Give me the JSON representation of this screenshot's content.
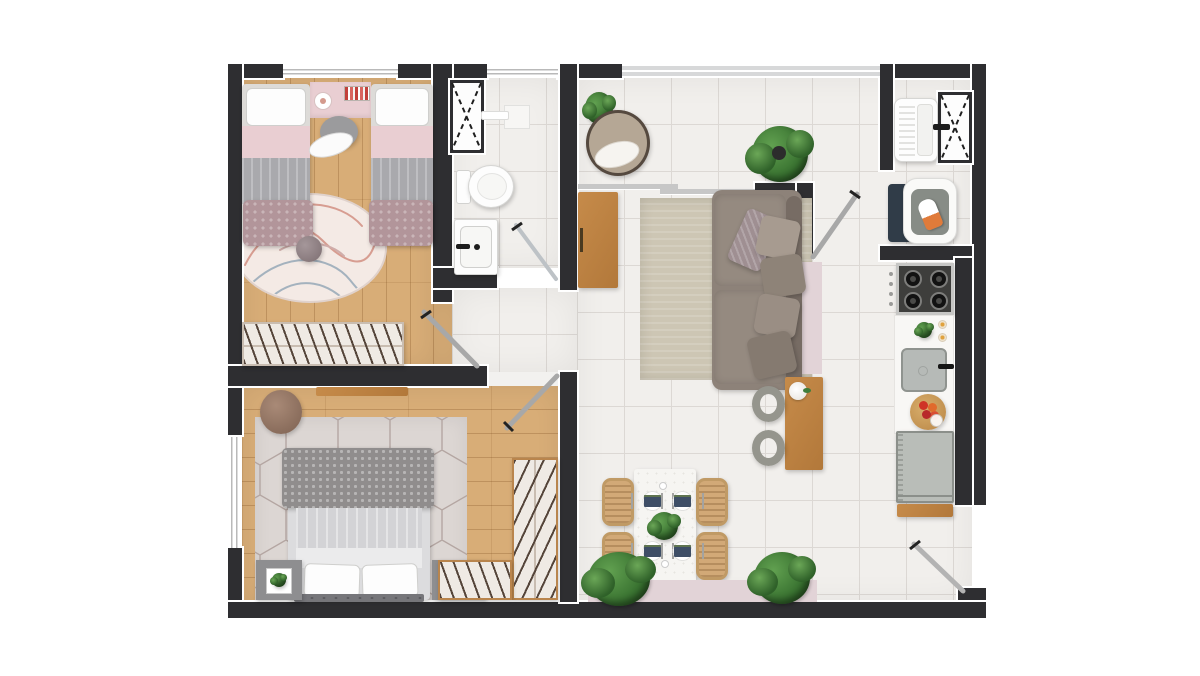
{
  "palette": {
    "background": "#ffffff",
    "wall": "#2e2e31",
    "tile_floor": "#f1efec",
    "tile_grout": "#dcd8d4",
    "wood_floor": "#d8ad77",
    "wood_furniture": "#c68b4a",
    "rug_living": "#cdc6b4",
    "rug_round": "#f4eae5",
    "rug_hex": "#dcd6d3",
    "hex_line": "#b4a6a2",
    "pink_accent": "#e9ced2",
    "mauve_band": "#e2d3d7",
    "sofa": "#8d8279",
    "sofa_dark": "#776c64",
    "gray_furniture": "#9b9b9d",
    "plant_green": "#37702f",
    "plant_green_dark": "#27511f",
    "appliance_gray": "#b9bdb8",
    "washer_navy": "#303c48",
    "door_leaf": "#a8a8a8",
    "glass": "#bdc2c6"
  },
  "plan": {
    "type": "apartment-floor-plan-top-view",
    "rooms": [
      {
        "name": "bedroom-1",
        "floor": "wood",
        "items": [
          "twin-bed-left",
          "twin-bed-right",
          "desk",
          "desk-lamp",
          "books",
          "desk-chair",
          "round-rug",
          "pompom",
          "wardrobe",
          "swing-door"
        ]
      },
      {
        "name": "bathroom",
        "floor": "tile",
        "items": [
          "duct-shaft",
          "shower-niche",
          "shower-bar",
          "toilet",
          "vanity-sink",
          "glass-shower-door"
        ]
      },
      {
        "name": "hallway",
        "floor": "tile",
        "items": []
      },
      {
        "name": "living-room",
        "floor": "tile",
        "items": [
          "armchair",
          "corner-plant",
          "monstera-plant",
          "sideboard",
          "area-rug",
          "sofa",
          "throw-pillows",
          "bar-table",
          "flower-vase",
          "bar-stool-1",
          "bar-stool-2",
          "service-door",
          "balcony-window",
          "sliding-track"
        ]
      },
      {
        "name": "dining-area",
        "floor": "tile",
        "items": [
          "dining-table",
          "dining-chair-1",
          "dining-chair-2",
          "dining-chair-3",
          "dining-chair-4",
          "place-setting-1",
          "place-setting-2",
          "place-setting-3",
          "place-setting-4",
          "centerpiece-plant",
          "floor-plant-left",
          "floor-plant-right",
          "planter-band"
        ]
      },
      {
        "name": "laundry",
        "floor": "tile",
        "items": [
          "laundry-tub",
          "tub-faucet",
          "washing-machine",
          "ironing-board",
          "iron",
          "duct-shaft"
        ]
      },
      {
        "name": "kitchen",
        "floor": "tile",
        "items": [
          "cooktop",
          "knob-strip",
          "counter",
          "counter-plant",
          "cups",
          "kitchen-sink",
          "sink-faucet",
          "fruit-bowl",
          "glass-cup",
          "fridge",
          "wood-shelf",
          "entry-door"
        ]
      },
      {
        "name": "bedroom-2",
        "floor": "wood",
        "items": [
          "double-bed",
          "knit-throw",
          "bed-pillows",
          "headboard",
          "nightstand-left",
          "framed-plant",
          "nightstand-right",
          "table-lamp",
          "pouf",
          "wall-shelf",
          "hex-rug",
          "wardrobe-right",
          "wardrobe-bottom",
          "swing-door",
          "window"
        ]
      }
    ]
  }
}
